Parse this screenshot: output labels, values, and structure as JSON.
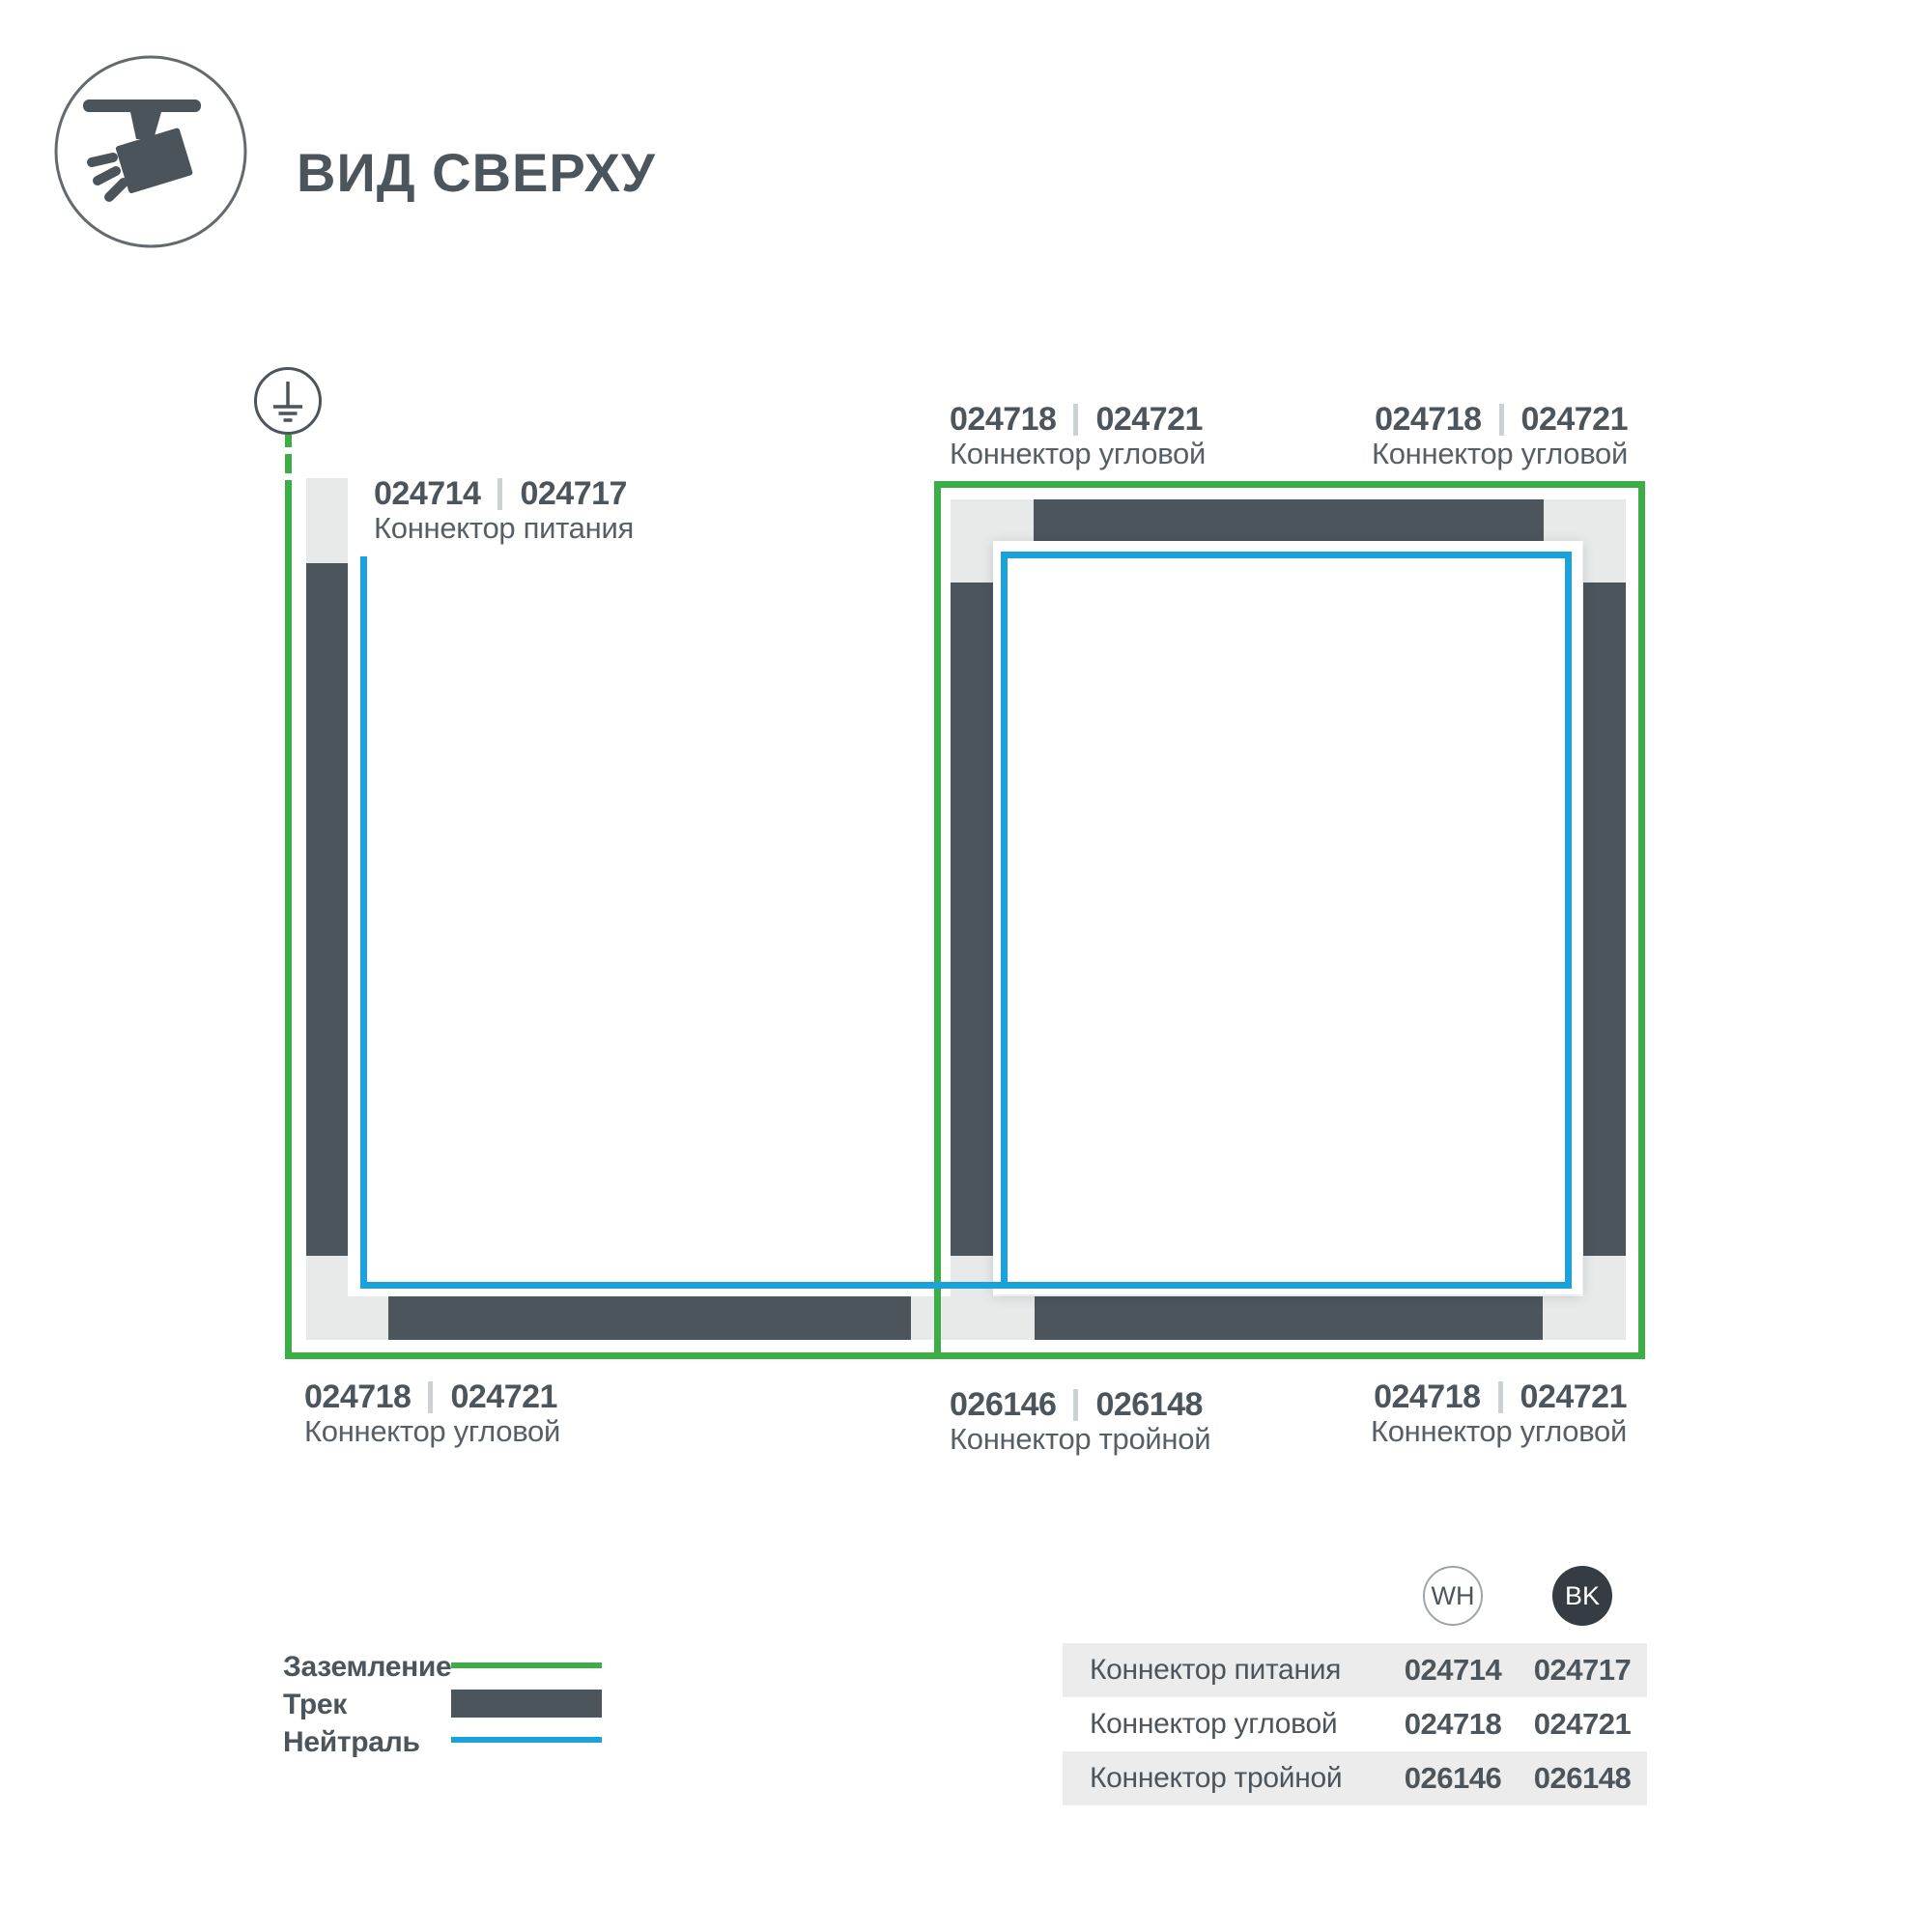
{
  "header": {
    "title": "ВИД СВЕРХУ",
    "icon": "track-spotlight"
  },
  "diagram": {
    "ground_symbol": "earth-ground",
    "labels": {
      "power": {
        "code_wh": "024714",
        "code_bk": "024717",
        "name": "Коннектор питания"
      },
      "top_left": {
        "code_wh": "024718",
        "code_bk": "024721",
        "name": "Коннектор угловой"
      },
      "top_right": {
        "code_wh": "024718",
        "code_bk": "024721",
        "name": "Коннектор угловой"
      },
      "bottom_left": {
        "code_wh": "024718",
        "code_bk": "024721",
        "name": "Коннектор угловой"
      },
      "bottom_middle": {
        "code_wh": "026146",
        "code_bk": "026148",
        "name": "Коннектор тройной"
      },
      "bottom_right": {
        "code_wh": "024718",
        "code_bk": "024721",
        "name": "Коннектор угловой"
      }
    }
  },
  "legend": {
    "items": [
      {
        "label": "Заземление",
        "swatch": "ground-line"
      },
      {
        "label": "Трек",
        "swatch": "track-bar"
      },
      {
        "label": "Нейтраль",
        "swatch": "neutral-line"
      }
    ]
  },
  "table": {
    "columns": [
      {
        "id": "wh",
        "label": "WH"
      },
      {
        "id": "bk",
        "label": "BK"
      }
    ],
    "rows": [
      {
        "name": "Коннектор питания",
        "wh": "024714",
        "bk": "024717"
      },
      {
        "name": "Коннектор угловой",
        "wh": "024718",
        "bk": "024721"
      },
      {
        "name": "Коннектор тройной",
        "wh": "026146",
        "bk": "026148"
      }
    ]
  },
  "colors": {
    "ground": "#3DAD46",
    "neutral": "#1BA2DB",
    "track": "#4C545C",
    "connector": "#E8EAEA",
    "text_dark": "#4C545C",
    "text_medium": "#575F66",
    "divider": "#CCD1D3",
    "stripe": "#ECECED",
    "bk_fill": "#363C43",
    "circle_border": "#9FA5A9"
  }
}
